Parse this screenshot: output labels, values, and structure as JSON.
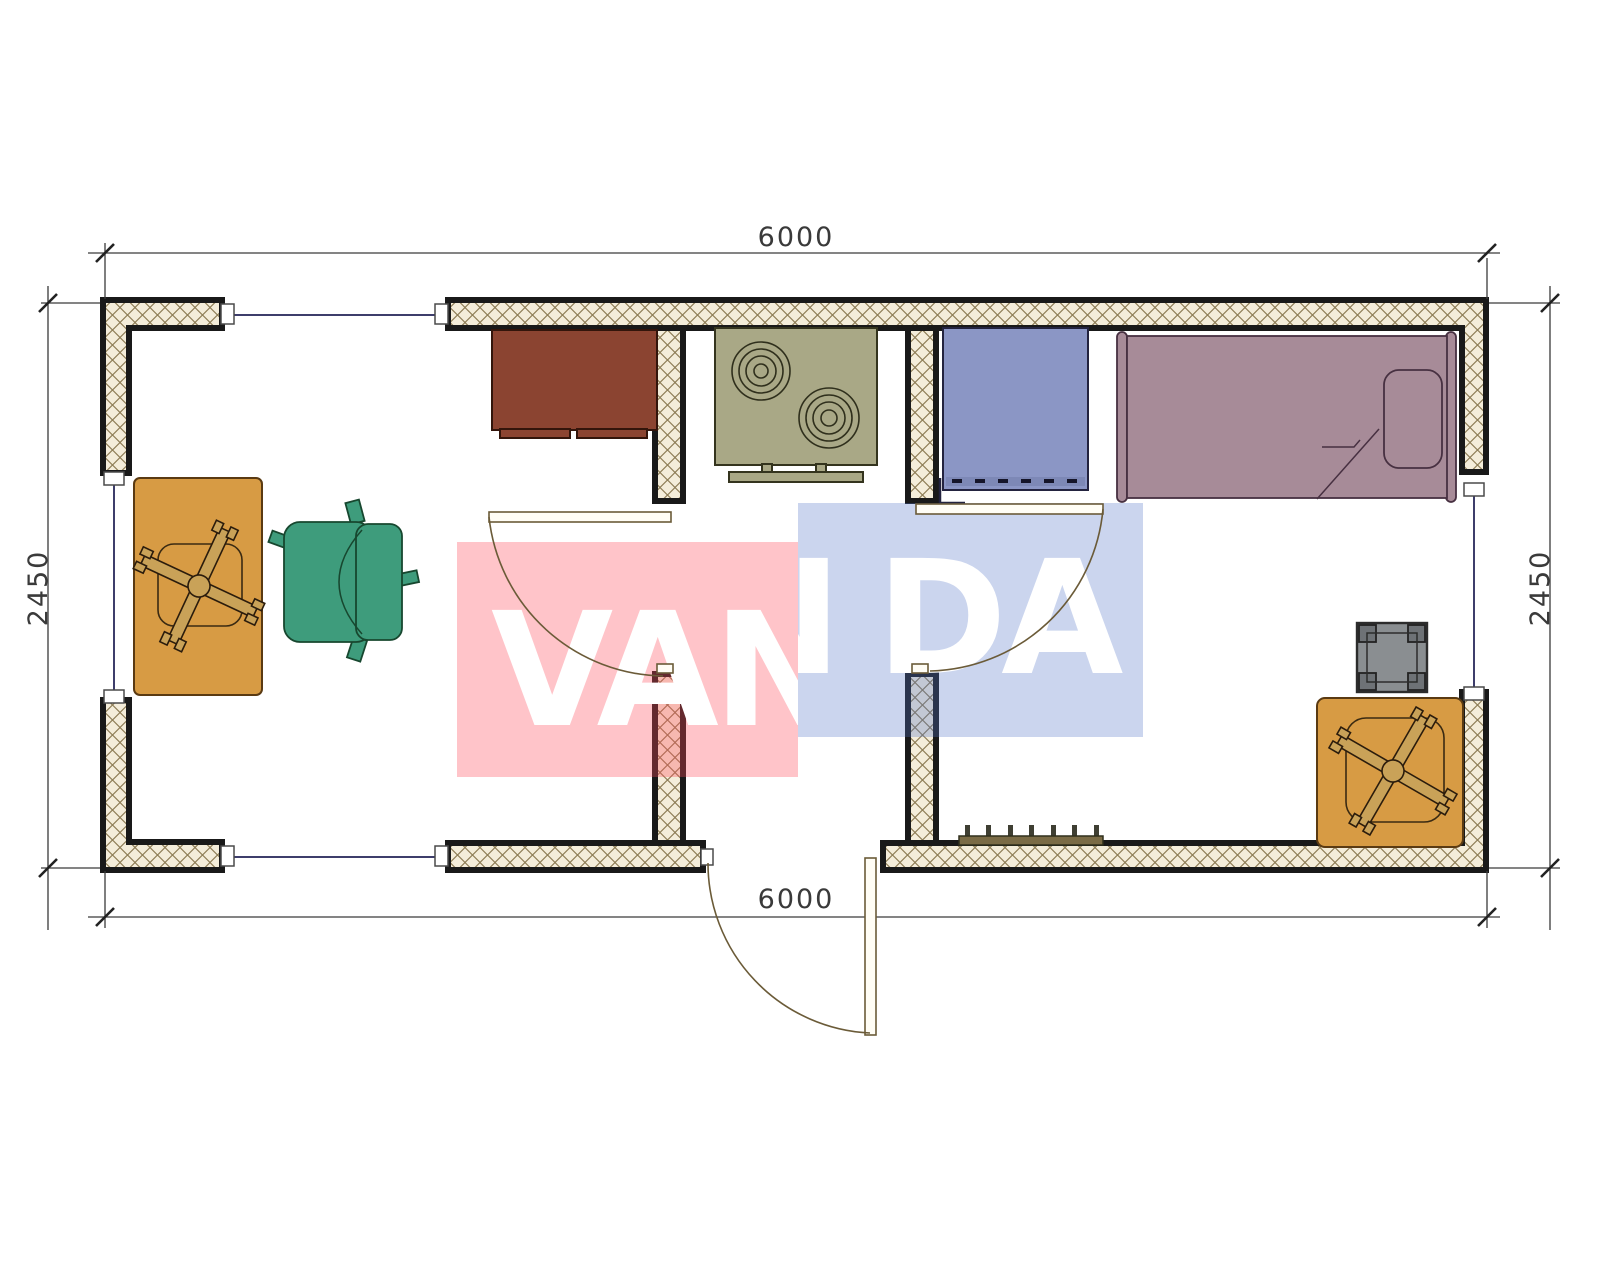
{
  "dimensions": {
    "top": "6000",
    "bottom": "6000",
    "left": "2450",
    "right": "2450"
  },
  "watermark": {
    "word": "VANDA",
    "pink_part": "VAN",
    "blue_partial": "N",
    "blue_part": "DA"
  },
  "furniture_icons": [
    "desk-table-icon",
    "office-chair-cross-icon",
    "armchair-icon",
    "cabinet-icon",
    "stove-two-burners-icon",
    "fridge-icon",
    "single-bed-icon",
    "pillow-icon",
    "stool-icon",
    "square-table-icon",
    "radiator-icon"
  ],
  "openings": [
    "window-top",
    "window-left",
    "window-right",
    "window-bottom-left",
    "door-living-kitchen",
    "door-kitchen-bedroom",
    "door-entrance"
  ],
  "theme": {
    "pink": "rgba(255,76,91,0.33)",
    "wmblue": "rgba(83,117,200,0.30)",
    "wallfill": "#f4edda",
    "wallline": "#8d7c55",
    "wallborder": "#191919",
    "win": "#3d3d6b",
    "dim": "#3a3a3a",
    "door": "#6b5b38",
    "orange": "#D79B44",
    "orangeline": "#5a3a12",
    "green": "#3E9C7C",
    "greenline": "#17472F",
    "brown": "#8B4431",
    "brownline": "#33150B",
    "olive": "#A9A886",
    "oliveline": "#34341e",
    "fridge": "#8B96C5",
    "fridgeline": "#23233f",
    "mauve": "#A78B98",
    "mauveline": "#473041",
    "gray": "#8A8E91",
    "wood": "#C9A258",
    "woodline": "#2b1c0c",
    "radiator": "#7A6B46"
  }
}
